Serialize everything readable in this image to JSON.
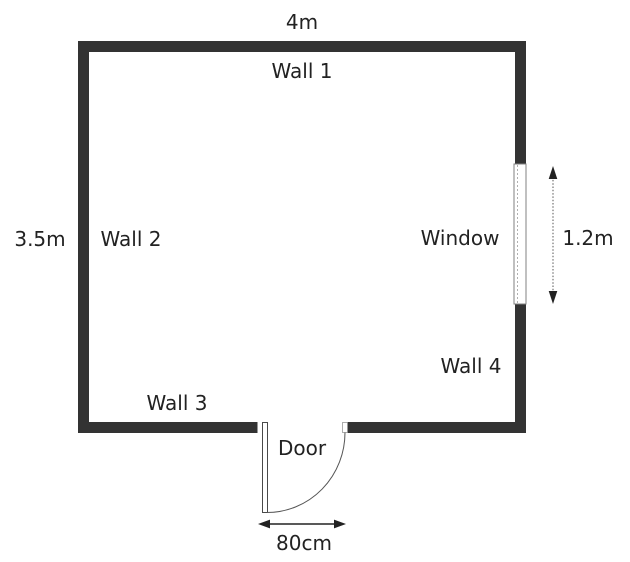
{
  "floorplan": {
    "dimensions": {
      "width": "4m",
      "height": "3.5m",
      "window": "1.2m",
      "door": "80cm"
    },
    "walls": [
      {
        "label": "Wall 1"
      },
      {
        "label": "Wall 2"
      },
      {
        "label": "Wall 3"
      },
      {
        "label": "Wall 4"
      }
    ],
    "features": {
      "window_label": "Window",
      "door_label": "Door"
    },
    "colors": {
      "wall": "#333333",
      "text": "#222222",
      "background": "#ffffff"
    }
  }
}
